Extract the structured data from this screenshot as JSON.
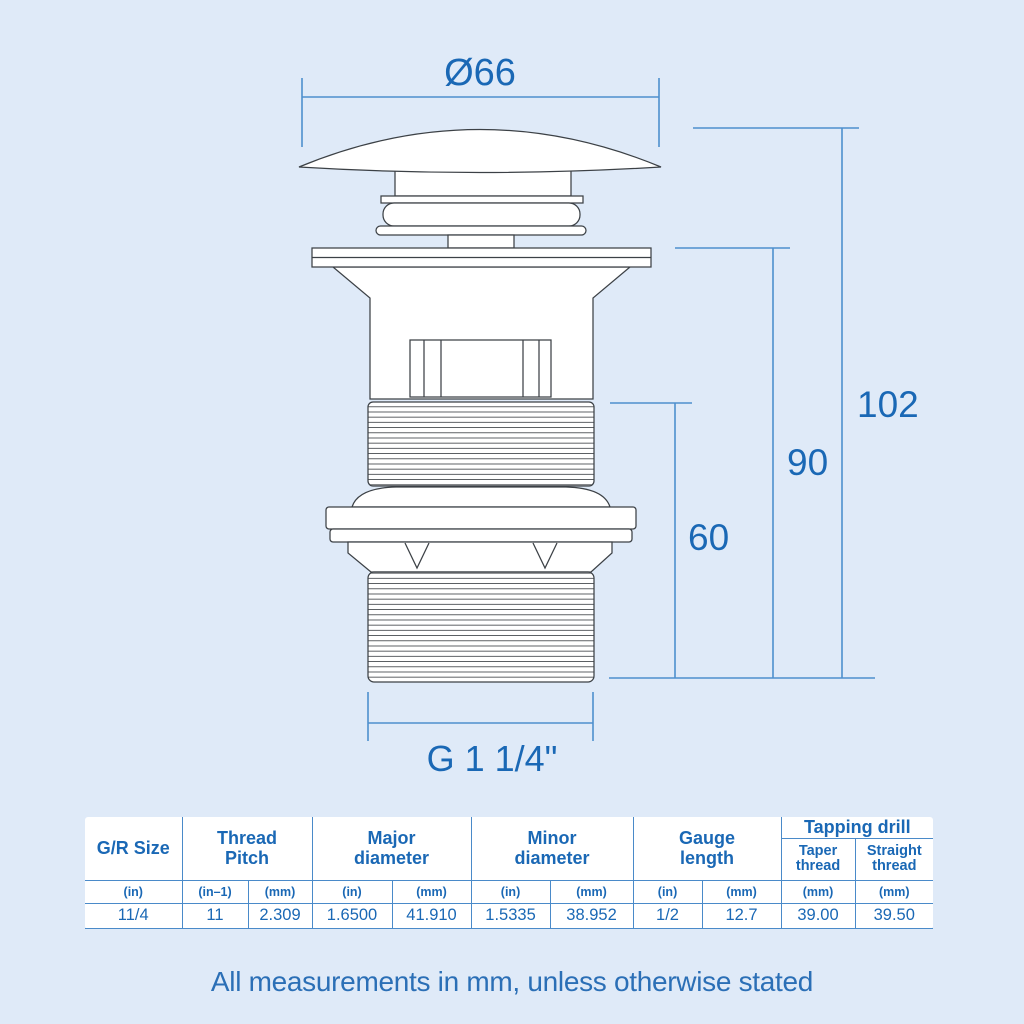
{
  "diagram": {
    "labels": {
      "diameter": "Ø66",
      "overall_height": "102",
      "height_90": "90",
      "height_60": "60",
      "thread_size": "G 1 1/4\""
    },
    "colors": {
      "background": "#dfeaf8",
      "outline": "#3c4146",
      "dimension_line": "#4e8fce",
      "dimension_text": "#1a68b5",
      "table_line": "#4a8ac9",
      "table_text": "#1a68b5"
    }
  },
  "table": {
    "columns": [
      {
        "label": "G/R Size",
        "units": [
          "(in)"
        ],
        "values": [
          "11/4"
        ]
      },
      {
        "label": "Thread Pitch",
        "units": [
          "(in–1)",
          "(mm)"
        ],
        "values": [
          "11",
          "2.309"
        ]
      },
      {
        "label": "Major diameter",
        "units": [
          "(in)",
          "(mm)"
        ],
        "values": [
          "1.6500",
          "41.910"
        ]
      },
      {
        "label": "Minor diameter",
        "units": [
          "(in)",
          "(mm)"
        ],
        "values": [
          "1.5335",
          "38.952"
        ]
      },
      {
        "label": "Gauge length",
        "units": [
          "(in)",
          "(mm)"
        ],
        "values": [
          "1/2",
          "12.7"
        ]
      },
      {
        "label": "Tapping drill",
        "sub_columns": [
          "Taper thread",
          "Straight thread"
        ],
        "units": [
          "(mm)",
          "(mm)"
        ],
        "values": [
          "39.00",
          "39.50"
        ]
      }
    ]
  },
  "footer": {
    "note": "All measurements in mm, unless otherwise stated"
  }
}
